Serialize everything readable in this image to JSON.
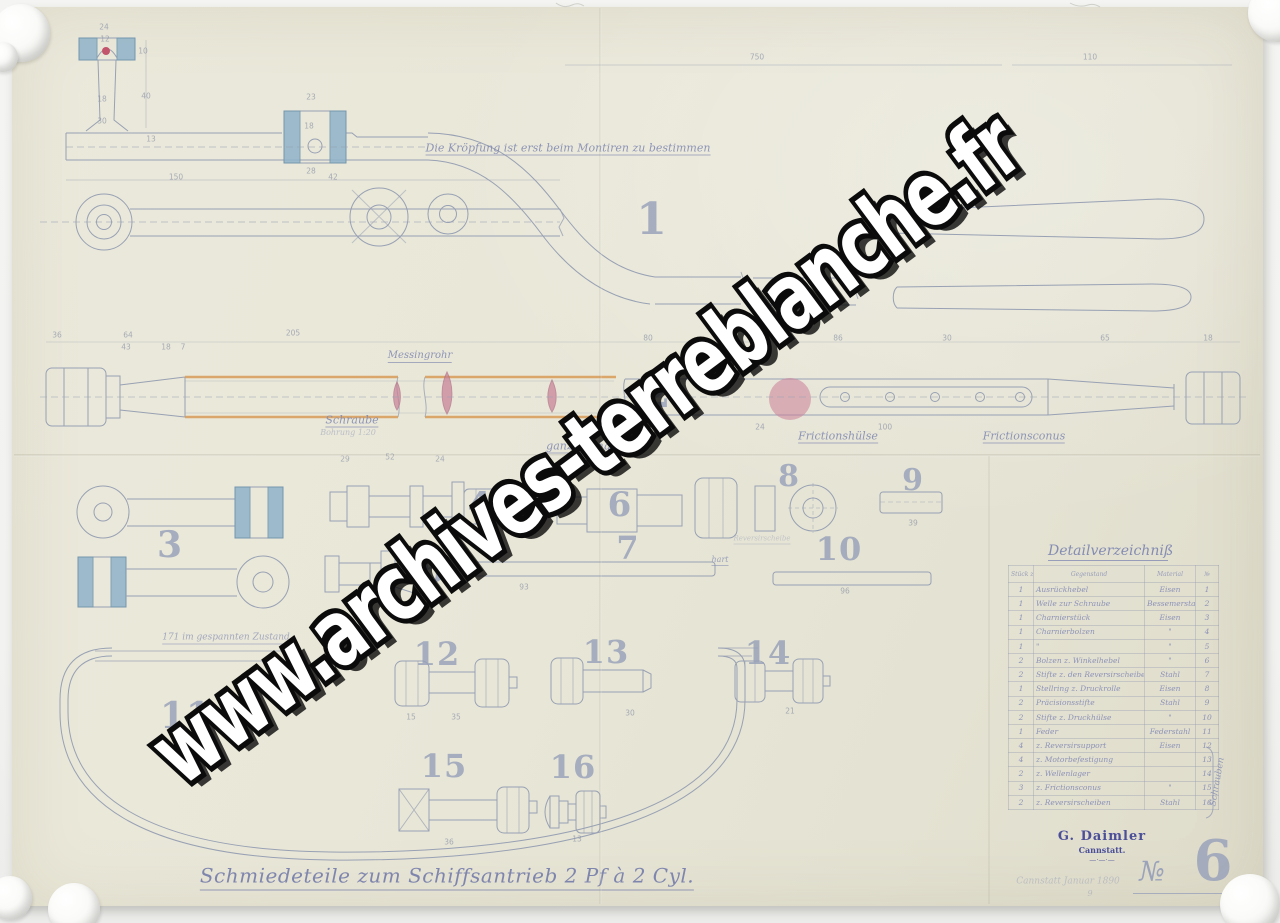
{
  "watermark": {
    "text": "www.archives-terreblanche.fr"
  },
  "sheet": {
    "title": "Schmiedeteile zum Schiffsantrieb 2 Pf à 2 Cyl.",
    "note_top": "Die Kröpfung ist erst beim Montiren zu bestimmen",
    "number_label": "№",
    "number": "6",
    "number_suffix": ".",
    "stamp": {
      "name": "G. Daimler",
      "city": "Cannstatt.",
      "flourish": "—·—·—"
    },
    "faint_note": "Cannstatt Januar 1890",
    "faint_note2": "9"
  },
  "part_numbers": [
    {
      "n": "1",
      "x": 652,
      "y": 220,
      "s": 44
    },
    {
      "n": "2",
      "x": 657,
      "y": 394,
      "s": 40
    },
    {
      "n": "3",
      "x": 170,
      "y": 545,
      "s": 36
    },
    {
      "n": "4",
      "x": 480,
      "y": 505,
      "s": 34
    },
    {
      "n": "5",
      "x": 434,
      "y": 571,
      "s": 32
    },
    {
      "n": "6",
      "x": 620,
      "y": 505,
      "s": 34
    },
    {
      "n": "7",
      "x": 628,
      "y": 548,
      "s": 32
    },
    {
      "n": "8",
      "x": 789,
      "y": 477,
      "s": 30
    },
    {
      "n": "9",
      "x": 913,
      "y": 481,
      "s": 30
    },
    {
      "n": "10",
      "x": 839,
      "y": 549,
      "s": 32
    },
    {
      "n": "11",
      "x": 186,
      "y": 716,
      "s": 36
    },
    {
      "n": "12",
      "x": 437,
      "y": 654,
      "s": 32
    },
    {
      "n": "13",
      "x": 606,
      "y": 652,
      "s": 32
    },
    {
      "n": "14",
      "x": 768,
      "y": 653,
      "s": 32
    },
    {
      "n": "15",
      "x": 444,
      "y": 766,
      "s": 32
    },
    {
      "n": "16",
      "x": 573,
      "y": 767,
      "s": 32
    }
  ],
  "labels": [
    {
      "t": "Die Kröpfung ist erst beim Montiren zu bestimmen",
      "x": 568,
      "y": 149,
      "s": 11,
      "u": true
    },
    {
      "t": "Schraube",
      "x": 352,
      "y": 421,
      "s": 11,
      "u": true
    },
    {
      "t": "Bohrung 1:20",
      "x": 348,
      "y": 433,
      "s": 8,
      "o": 0.45
    },
    {
      "t": "Messingrohr",
      "x": 420,
      "y": 357,
      "s": 10,
      "u": true
    },
    {
      "t": "ganze Länge =",
      "x": 588,
      "y": 447,
      "s": 11,
      "u": true
    },
    {
      "t": "Frictionshülse",
      "x": 838,
      "y": 437,
      "s": 11,
      "u": true
    },
    {
      "t": "Frictionsconus",
      "x": 1024,
      "y": 437,
      "s": 11,
      "u": true
    },
    {
      "t": "171 im gespannten Zustand",
      "x": 226,
      "y": 639,
      "s": 9,
      "u": true,
      "o": 0.7
    },
    {
      "t": "hart",
      "x": 720,
      "y": 561,
      "s": 8,
      "u": true,
      "o": 0.75
    },
    {
      "t": "Reversirscheibe",
      "x": 762,
      "y": 540,
      "s": 7,
      "u": true,
      "o": 0.35
    },
    {
      "t": "Schrauben",
      "x": 1218,
      "y": 782,
      "s": 9,
      "r": -80,
      "o": 0.8
    },
    {
      "t": "Cannstatt Januar 1890",
      "x": 1068,
      "y": 882,
      "s": 9,
      "o": 0.38
    },
    {
      "t": "9",
      "x": 1090,
      "y": 894,
      "s": 8,
      "o": 0.38
    }
  ],
  "dimensions": [
    {
      "t": "24",
      "x": 104,
      "y": 27
    },
    {
      "t": "12",
      "x": 105,
      "y": 39
    },
    {
      "t": "10",
      "x": 143,
      "y": 51
    },
    {
      "t": "18",
      "x": 102,
      "y": 99
    },
    {
      "t": "30",
      "x": 102,
      "y": 121
    },
    {
      "t": "40",
      "x": 146,
      "y": 96
    },
    {
      "t": "13",
      "x": 151,
      "y": 139
    },
    {
      "t": "150",
      "x": 176,
      "y": 177
    },
    {
      "t": "42",
      "x": 333,
      "y": 177
    },
    {
      "t": "23",
      "x": 311,
      "y": 97
    },
    {
      "t": "18",
      "x": 309,
      "y": 126
    },
    {
      "t": "28",
      "x": 311,
      "y": 171
    },
    {
      "t": "750",
      "x": 757,
      "y": 57
    },
    {
      "t": "110",
      "x": 1090,
      "y": 57
    },
    {
      "t": "36",
      "x": 57,
      "y": 335
    },
    {
      "t": "64",
      "x": 128,
      "y": 335
    },
    {
      "t": "43",
      "x": 126,
      "y": 347
    },
    {
      "t": "18",
      "x": 166,
      "y": 347
    },
    {
      "t": "7",
      "x": 183,
      "y": 347
    },
    {
      "t": "205",
      "x": 293,
      "y": 333
    },
    {
      "t": "80",
      "x": 648,
      "y": 338
    },
    {
      "t": "86",
      "x": 838,
      "y": 338
    },
    {
      "t": "30",
      "x": 947,
      "y": 338
    },
    {
      "t": "65",
      "x": 1105,
      "y": 338
    },
    {
      "t": "18",
      "x": 1208,
      "y": 338
    },
    {
      "t": "24",
      "x": 760,
      "y": 427
    },
    {
      "t": "100",
      "x": 885,
      "y": 427
    },
    {
      "t": "39",
      "x": 913,
      "y": 523
    },
    {
      "t": "52",
      "x": 390,
      "y": 457
    },
    {
      "t": "29",
      "x": 345,
      "y": 459
    },
    {
      "t": "24",
      "x": 440,
      "y": 459
    },
    {
      "t": "93",
      "x": 524,
      "y": 587
    },
    {
      "t": "96",
      "x": 845,
      "y": 591
    },
    {
      "t": "15",
      "x": 411,
      "y": 717
    },
    {
      "t": "35",
      "x": 456,
      "y": 717
    },
    {
      "t": "30",
      "x": 630,
      "y": 713
    },
    {
      "t": "21",
      "x": 790,
      "y": 711
    },
    {
      "t": "36",
      "x": 449,
      "y": 842
    },
    {
      "t": "13",
      "x": 577,
      "y": 839
    }
  ],
  "table": {
    "title": "Detailverzeichniß",
    "headers": {
      "qty": "Stück zahl",
      "item": "Gegenstand",
      "mat": "Material",
      "no": "№"
    },
    "side_label": "Schrauben",
    "rows": [
      {
        "qty": "1",
        "item": "Ausrückhebel",
        "mat": "Eisen",
        "no": "1"
      },
      {
        "qty": "1",
        "item": "Welle zur Schraube",
        "mat": "Bessemerstahl",
        "no": "2"
      },
      {
        "qty": "1",
        "item": "Charnierstück",
        "mat": "Eisen",
        "no": "3"
      },
      {
        "qty": "1",
        "item": "Charnierbolzen",
        "mat": "\"",
        "no": "4"
      },
      {
        "qty": "1",
        "item": "\"",
        "mat": "\"",
        "no": "5"
      },
      {
        "qty": "2",
        "item": "Bolzen z. Winkelhebel",
        "mat": "\"",
        "no": "6"
      },
      {
        "qty": "2",
        "item": "Stifte z. den Reversirscheiben",
        "mat": "Stahl",
        "no": "7"
      },
      {
        "qty": "1",
        "item": "Stellring z. Druckrolle",
        "mat": "Eisen",
        "no": "8"
      },
      {
        "qty": "2",
        "item": "Präcisionsstifte",
        "mat": "Stahl",
        "no": "9"
      },
      {
        "qty": "2",
        "item": "Stifte z. Druckhülse",
        "mat": "\"",
        "no": "10"
      },
      {
        "qty": "1",
        "item": "Feder",
        "mat": "Federstahl",
        "no": "11"
      },
      {
        "qty": "4",
        "item": "z. Reversirsupport",
        "mat": "Eisen",
        "no": "12"
      },
      {
        "qty": "4",
        "item": "z. Motorbefestigung",
        "mat": "",
        "no": "13"
      },
      {
        "qty": "2",
        "item": "z. Wellenlager",
        "mat": "",
        "no": "14"
      },
      {
        "qty": "3",
        "item": "z. Frictionsconus",
        "mat": "\"",
        "no": "15"
      },
      {
        "qty": "2",
        "item": "z. Reversirscheiben",
        "mat": "Stahl",
        "no": "16"
      }
    ]
  }
}
